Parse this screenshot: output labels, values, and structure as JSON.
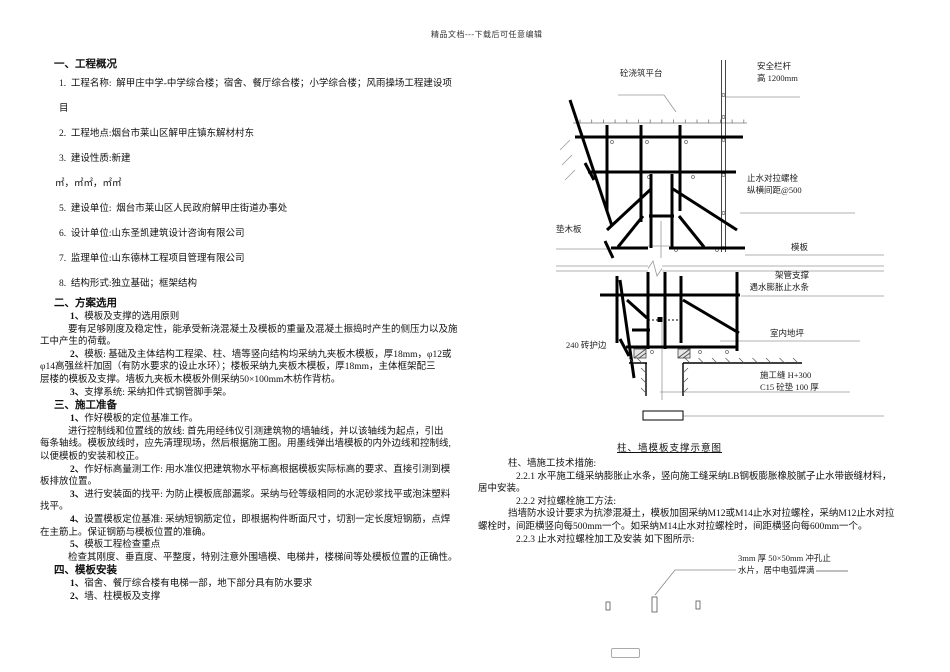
{
  "watermark": "精品文档---下载后可任意编辑",
  "left_lines": [
    {
      "c": "h",
      "t": "一、工程概况"
    },
    {
      "c": "i",
      "t": "1.  工程名称:  解甲庄中学-中学综合楼；宿舍、餐厅综合楼；小学综合楼；风雨操场工程建设项"
    },
    {
      "c": "i",
      "t": "目"
    },
    {
      "c": "i",
      "t": "2.  工程地点:烟台市莱山区解甲庄镇东解材村东"
    },
    {
      "c": "i",
      "t": "3.  建设性质:新建"
    },
    {
      "c": "m",
      "t": "㎡，㎡㎡，㎡㎡"
    },
    {
      "c": "i",
      "t": "5.  建设单位:  烟台市莱山区人民政府解甲庄街道办事处"
    },
    {
      "c": "i",
      "t": "6.  设计单位:山东圣凯建筑设计咨询有限公司"
    },
    {
      "c": "i",
      "t": "7.  监理单位:山东德林工程项目管理有限公司"
    },
    {
      "c": "i",
      "t": "8.  结构形式:独立基础；框架结构"
    },
    {
      "c": "h",
      "t": "二、方案选用"
    },
    {
      "c": "s",
      "b": "1、",
      "t": "模板及支撑的选用原则"
    },
    {
      "c": "ti",
      "t": "要有足够刚度及稳定性，能承受新浇混凝土及模板的重量及混凝土振捣时产生的侧压力以及施"
    },
    {
      "c": "t",
      "t": "工中产生的荷载。"
    },
    {
      "c": "s",
      "b": "2、",
      "t": "模板: 基础及主体结构工程梁、柱、墙等竖向结构均采纳九夹板木模板，厚18mm，φ12或"
    },
    {
      "c": "t",
      "t": "φ14高强丝杆加固（有防水要求的设止水环）；楼板采纳九夹板木模板，厚18mm，主体框架配三"
    },
    {
      "c": "t",
      "t": "层楼的模板及支撑。墙板九夹板木模板外侧采纳50×100mm木枋作背枋。"
    },
    {
      "c": "s",
      "b": "3、",
      "t": "支撑系统: 采纳扣件式钢管脚手架。"
    },
    {
      "c": "h",
      "t": "三、施工准备"
    },
    {
      "c": "s",
      "b": "1、",
      "t": "作好模板的定位基准工作。"
    },
    {
      "c": "ti",
      "t": "进行控制线和位置线的放线: 首先用经纬仪引测建筑物的墙轴线，并以该轴线为起点，引出"
    },
    {
      "c": "t",
      "t": "每条轴线。模板放线时，应先清理现场，然后根据施工图。用墨线弹出墙模板的内外边线和控制线,"
    },
    {
      "c": "t",
      "t": "以便模板的安装和校正。"
    },
    {
      "c": "s",
      "b": "2、",
      "t": "作好标高量测工作: 用水准仪把建筑物水平标高根据模板实际标高的要求、直接引测到模"
    },
    {
      "c": "t",
      "t": "板排放位置。"
    },
    {
      "c": "s",
      "b": "3、",
      "t": "进行安装面的找平: 为防止模板底部漏浆。采纳与砼等级相同的水泥砂浆找平或泡沫塑料"
    },
    {
      "c": "t",
      "t": "找平。"
    },
    {
      "c": "s",
      "b": "4、",
      "t": "设置模板定位基准: 采纳短钢筋定位，即根据构件断面尺寸，切割一定长度短钢筋，点焊"
    },
    {
      "c": "t",
      "t": "在主筋上。保证钢筋与模板位置的准确。"
    },
    {
      "c": "s",
      "b": "5、",
      "t": "模板工程检查重点"
    },
    {
      "c": "ti",
      "t": "检查其刚度、垂直度、平整度，特别注意外围墙模、电梯井，楼梯间等处模板位置的正确性。"
    },
    {
      "c": "h",
      "t": "四、模板安装"
    },
    {
      "c": "s",
      "b": "1、",
      "t": "宿舍、餐厅综合楼有电梯一部，地下部分具有防水要求"
    },
    {
      "c": "s",
      "b": "2、",
      "t": "墙、柱模板及支撑"
    }
  ],
  "caption": "柱、墙模板支撑示意图",
  "right_lines": [
    {
      "c": "r1",
      "t": "柱、墙施工技术措施:"
    },
    {
      "c": "r2",
      "t": "2.2.1 水平施工缝采纳膨胀止水条，竖向施工缝采纳LB钢板膨胀橡胶腻子止水带嵌缝材料，"
    },
    {
      "c": "t",
      "t": "居中安装。"
    },
    {
      "c": "r2",
      "t": "2.2.2 对拉螺栓施工方法:"
    },
    {
      "c": "r1",
      "t": "挡墙防水设计要求为抗渗混凝土，模板加固采纳M12或M14止水对拉螺栓，采纳M12止水对拉"
    },
    {
      "c": "t",
      "t": "螺栓时，间距横竖向每500mm一个。如采纳M14止水对拉螺栓时，间距横竖向每600mm一个。"
    },
    {
      "c": "r2",
      "t": "2.2.3 止水对拉螺栓加工及安装 如下图所示:"
    }
  ],
  "diagram_labels": {
    "platform": "砼浇筑平台",
    "rail1": "安全栏杆",
    "rail2": "高 1200mm",
    "bolt1": "止水对拉螺栓",
    "bolt2": "纵横间距@500",
    "pad": "垫木板",
    "formwork": "模板",
    "support1": "架管支撑",
    "support2": "遇水膨胀止水条",
    "floor": "室内地坪",
    "brick": "240 砖护边",
    "joint1": "施工缝 H+300",
    "joint2": "C15 砼垫 100 厚",
    "plate1": "3mm 厚 50×50mm 冲孔止",
    "plate2": "水片，居中电弧焊满"
  }
}
